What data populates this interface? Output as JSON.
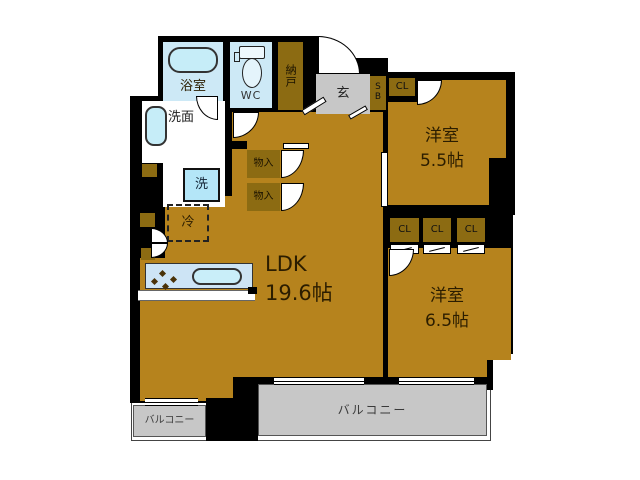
{
  "plan": {
    "bathroom_label": "浴室",
    "toilet_label": "WC",
    "storage_label": "納戸",
    "entrance_label": "玄",
    "shoebox_line1": "S",
    "shoebox_line2": "B",
    "closet_top_label": "CL",
    "bedroom1_name": "洋室",
    "bedroom1_size": "5.5帖",
    "washroom_label": "洗面",
    "washer_label": "洗",
    "closet_a_label": "物入",
    "closet_b_label": "物入",
    "fridge_label": "冷",
    "ldk_name": "LDK",
    "ldk_size": "19.6帖",
    "closet_row": [
      "CL",
      "CL",
      "CL"
    ],
    "bedroom2_name": "洋室",
    "bedroom2_size": "6.5帖",
    "balcony_small_label": "バルコニー",
    "balcony_large_label": "バルコニー"
  },
  "colors": {
    "floor": "#b6831d",
    "closet": "#8c6b12",
    "wet_area": "#cde9f6",
    "fixture": "#c6edf8",
    "gray_area": "#c7c7c7",
    "wall": "#000000",
    "label_text": "#2b1d00"
  }
}
